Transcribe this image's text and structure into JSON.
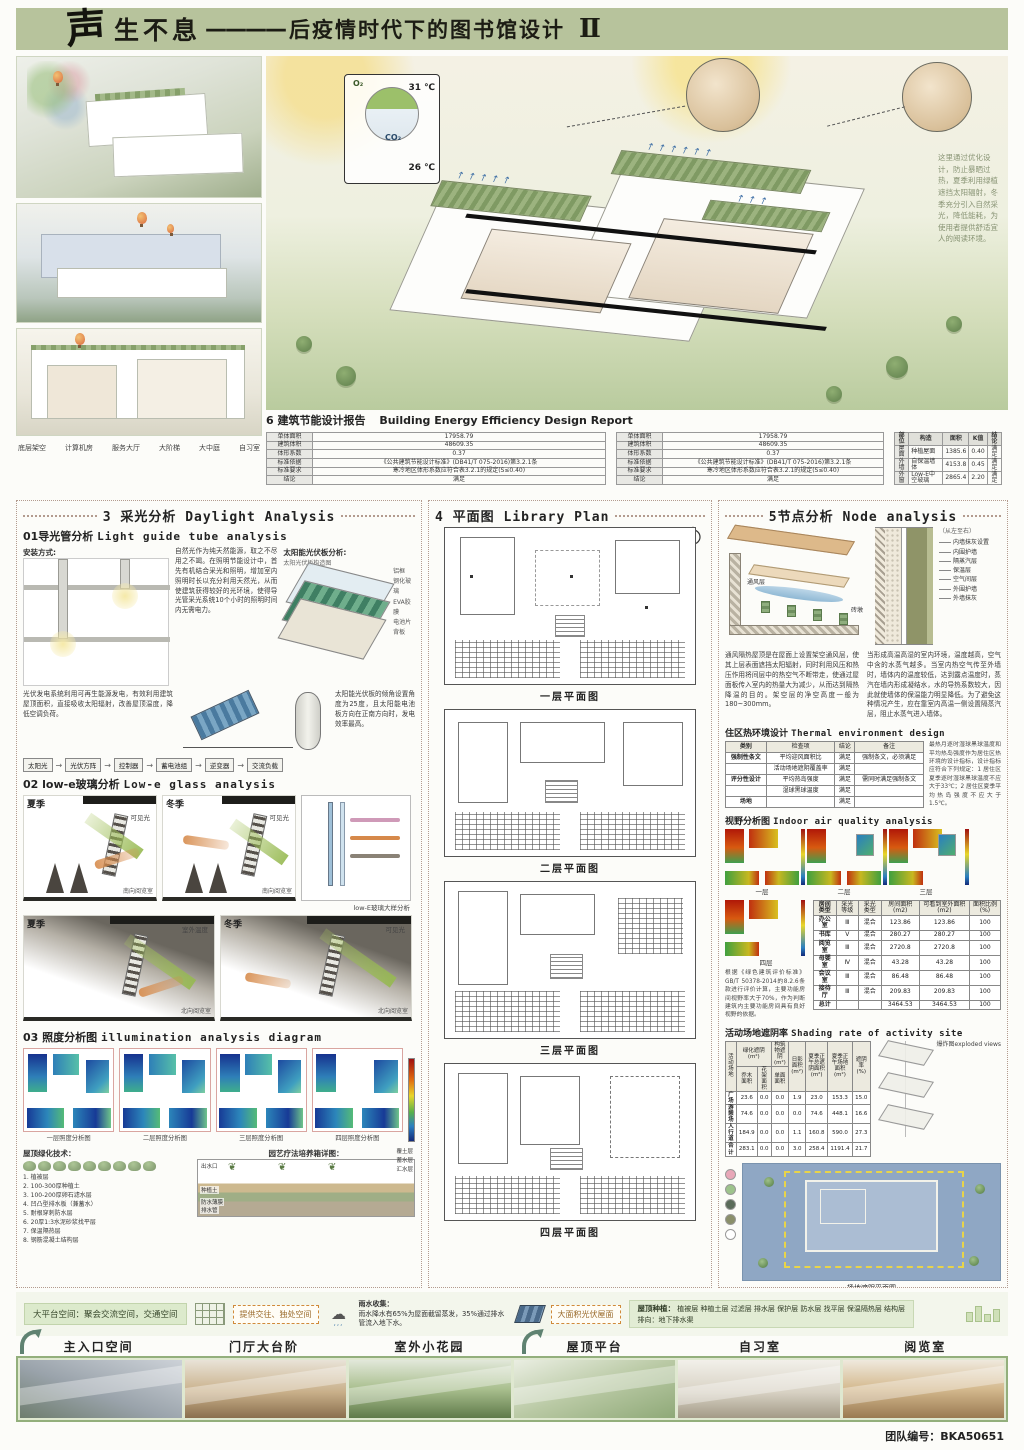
{
  "header": {
    "calligraphy": "声",
    "title": "生不息",
    "dash": "————",
    "subtitle": "后疫情时代下的图书馆设计",
    "numeral": "Ⅱ"
  },
  "top": {
    "section_labels": [
      "底层架空",
      "计算机房",
      "服务大厅",
      "大阶梯",
      "大中庭",
      "自习室"
    ],
    "env": {
      "o2": "O₂",
      "temp_high": "31 ℃",
      "co2": "CO₂",
      "temp_low": "26 ℃"
    },
    "overlay_text": "这里通过优化设计，防止暴晒过热，夏季利用绿植遮挡太阳辐射，冬季充分引入自然采光，降低能耗，为使用者提供舒适宜人的阅读环境。",
    "energy": {
      "heading_zh": "6 建筑节能设计报告",
      "heading_en": "Building Energy Efficiency Design Report",
      "t1_rows": [
        [
          "单体面积",
          "17958.79"
        ],
        [
          "建筑体积",
          "48609.35"
        ],
        [
          "体形系数",
          "0.37"
        ],
        [
          "标准依据",
          "《公共建筑节能设计标准》(DB41/T 075-2016)第3.2.1条"
        ],
        [
          "标准要求",
          "寒冷地区体形系数应符合表3.2.1的规定(S≤0.40)"
        ],
        [
          "结论",
          "满足"
        ]
      ],
      "t2_rows": [
        [
          "单体面积",
          "17958.79"
        ],
        [
          "建筑体积",
          "48609.35"
        ],
        [
          "体形系数",
          "0.37"
        ],
        [
          "标准依据",
          "《公共建筑节能设计标准》(DB41/T 075-2016)第3.2.1条"
        ],
        [
          "标准要求",
          "寒冷地区体形系数应符合表3.2.1的规定(S≤0.40)"
        ],
        [
          "结论",
          "满足"
        ]
      ],
      "t3_head": [
        "部位",
        "构造",
        "面积",
        "K值",
        "结论"
      ],
      "t3_rows": [
        [
          "屋面",
          "种植屋面",
          "1385.6",
          "0.40",
          "满足"
        ],
        [
          "外墙",
          "自保温墙体",
          "4153.8",
          "0.45",
          "满足"
        ],
        [
          "外窗",
          "Low-E中空玻璃",
          "2865.4",
          "2.20",
          "满足"
        ]
      ]
    }
  },
  "daylight": {
    "header": {
      "num": "3",
      "zh": "采光分析",
      "en": "Daylight Analysis"
    },
    "s1_zh": "01导光管分析",
    "s1_en": "Light guide tube analysis",
    "install_label": "安装方式:",
    "para": "自然光作为纯天然能源，取之不尽用之不竭。在照明节能设计中，首先有机结合采光和照明，增加室内照明时长以充分利用天然光，从而使建筑获得较好的光环境，使得导光管采光系统10个小时的照明时间内无需电力。",
    "pv_title": "太阳能光伏板分析:",
    "pv_sub": "太阳光伏板构造图",
    "pv_layers": "铝框\n钢化玻璃\nEVA胶膜\n电池片\n背板",
    "pv_para": "光伏发电系统利用可再生能源发电，有效利用建筑屋顶面积，直接吸收太阳辐射，改善屋顶温度，降低空调负荷。",
    "tilt_note": "太阳能光伏板的倾角设置角度为25度，且太阳能电池板方向在正南方向时，发电效率最高。",
    "flow": [
      "太阳光",
      "光伏方阵",
      "控制器",
      "蓄电池组",
      "逆变器",
      "交流负载"
    ],
    "s2_zh": "02 low-e玻璃分析",
    "s2_en": "Low-e glass analysis",
    "diagrams": [
      {
        "season": "夏季",
        "room": "南向阅览室",
        "beam": "可见光"
      },
      {
        "season": "冬季",
        "room": "南向阅览室",
        "beam": "可见光"
      },
      {
        "season": "夏季",
        "room": "北向阅览室",
        "beam": "室外温度"
      },
      {
        "season": "冬季",
        "room": "北向阅览室",
        "beam": "可见光"
      }
    ],
    "lowe_detail_caption": "low-E玻璃大样分析",
    "s3_zh": "03 照度分析图",
    "s3_en": "illumination analysis diagram",
    "illum_captions": [
      "一层照度分析图",
      "二层照度分析图",
      "三层照度分析图",
      "四层照度分析图"
    ],
    "roof_tech_title": "屋顶绿化技术：",
    "roof_tech_list": "1. 植被层\n2. 100-300厚种植土\n3. 100-200厚卵石滤水层\n4. 凹凸型排水板（兼蓄水）\n5. 耐根穿刺防水层\n6. 20厚1:3水泥砂浆找平层\n7. 保温隔热层\n8. 钢筋混凝土结构层",
    "garden_title": "园艺疗法培养箱详图：",
    "garden_labels": {
      "outlet": "出水口",
      "membrane": "防水薄膜",
      "soil": "种植土",
      "drain": "排水管"
    },
    "garden_side": "覆土层\n蓄水层\n汇水层"
  },
  "plans": {
    "header": {
      "num": "4",
      "zh": "平面图",
      "en": "Library Plan"
    },
    "captions": [
      "一层平面图",
      "二层平面图",
      "三层平面图",
      "四层平面图"
    ]
  },
  "node": {
    "header": {
      "zh": "5节点分析",
      "en": "Node analysis"
    },
    "roof_label_vent": "通风层",
    "roof_label_brick": "砖墩",
    "wall_dir": "（从左至右）",
    "wall_layers": [
      "内墙抹灰设置",
      "内围护墙",
      "隔蒸汽层",
      "保温层",
      "空气间层",
      "外围护墙",
      "外墙抹灰"
    ],
    "para1": "通风隔热屋顶是在屋面上设置架空通风层，使其上层表面遮挡太阳辐射，同时利用风压和热压作用将间层中的热空气不断带走，使通过屋面板传入室内的热量大为减少，从而达到隔热降温的目的。架空层的净空高度一般为180~300mm。",
    "para2": "当形成高温高湿的室内环境，温度越高，空气中含的水蒸气越多。当室内热空气传至外墙时，墙体内的温度较低，达到露点温度时，蒸汽在墙内形成凝结水，水的导热系数较大，因此就使墙体的保温能力明显降低。为了避免这种情况产生，应在靠室内高温一侧设置隔蒸汽层，阻止水蒸气进入墙体。",
    "thermal_zh": "住区热环境设计",
    "thermal_en": "Thermal environment design",
    "thermal_head": [
      "类别",
      "检查项",
      "结论",
      "备注"
    ],
    "thermal_rows": [
      [
        "强制性条文",
        "平均迎风面积比",
        "满足",
        "强制条文，必须满足"
      ],
      [
        "",
        "活动场地遮阴覆盖率",
        "满足",
        ""
      ],
      [
        "评分性设计",
        "平均热岛强度",
        "满足",
        "需同时满足强制条文"
      ],
      [
        "",
        "湿球黑球温度",
        "满足",
        ""
      ],
      [
        "场地",
        "",
        "满足",
        ""
      ]
    ],
    "thermal_note": "最热月逐时湿球黑球温度和平均热岛强度作为居住区热环境的设计指标，设计指标应符合下列规定：1 居住区夏季逐时湿球黑球温度不应大于33℃；2 居住区夏季平均热岛强度不应大于1.5℃。",
    "view_zh": "视野分析图",
    "view_en": "Indoor air quality analysis",
    "view_floors": [
      "一层",
      "二层",
      "三层",
      "四层"
    ],
    "view_note": "根据《绿色建筑评价标准》GB/T 50378-2014的8.2.6条款进行评价计算，主要功能房间视野率大于70%，作为判断建筑内主要功能房间具有良好视野的依据。",
    "room_head": [
      "房间类型",
      "采光等级",
      "采光类型",
      "房间面积(m2)",
      "可看到室外面积(m2)",
      "面积比例(%)"
    ],
    "room_rows": [
      [
        "办公室",
        "Ⅲ",
        "混合",
        "123.86",
        "123.86",
        "100"
      ],
      [
        "书库",
        "Ⅴ",
        "混合",
        "280.27",
        "280.27",
        "100"
      ],
      [
        "阅览室",
        "Ⅲ",
        "混合",
        "2720.8",
        "2720.8",
        "100"
      ],
      [
        "母婴室",
        "Ⅳ",
        "混合",
        "43.28",
        "43.28",
        "100"
      ],
      [
        "会议室",
        "Ⅲ",
        "混合",
        "86.48",
        "86.48",
        "100"
      ],
      [
        "接待厅",
        "Ⅲ",
        "混合",
        "209.83",
        "209.83",
        "100"
      ],
      [
        "总计",
        "",
        "",
        "3464.53",
        "3464.53",
        "100"
      ]
    ],
    "shading_zh": "活动场地遮阴率",
    "shading_en": "Shading rate of activity site",
    "shading_h": [
      "活动场地",
      "绿化遮阴(m²)",
      "构筑物遮阴(m²)",
      "日影面积(m²)",
      "夏季正午总遮阴面积(m²)",
      "夏季正午场地面积(m²)",
      "遮阴率(%)"
    ],
    "shading_sub": [
      "乔木面积",
      "花架面积",
      "单面面积"
    ],
    "shading_rows": [
      [
        "广场",
        "23.6",
        "0.0",
        "0.0",
        "1.9",
        "23.0",
        "153.3",
        "15.0"
      ],
      [
        "游憩场",
        "74.6",
        "0.0",
        "0.0",
        "0.0",
        "74.6",
        "448.1",
        "16.6"
      ],
      [
        "人行道",
        "184.9",
        "0.0",
        "0.0",
        "1.1",
        "160.8",
        "590.0",
        "27.3"
      ],
      [
        "合计",
        "283.1",
        "0.0",
        "0.0",
        "3.0",
        "258.4",
        "1191.4",
        "21.7"
      ]
    ],
    "exploded_label": "爆炸图exploded views",
    "siteplan_caption": "场地遮阴平面图",
    "roof_index_zh": "屋顶热环境指标",
    "roof_index_en": "Roof thermal environment index",
    "roof_head": [
      "建筑",
      "屋顶面积(m2)",
      "屋顶绿化面积(m2)",
      "太阳能板遮阴面积(m2)",
      "太阳辐射反射系数不小于0.4屋面面积(m2)",
      "屋顶绿化、太阳能板遮阴及反射达标面积占屋面比例(%)"
    ],
    "roof_rows": [
      [
        "",
        "1385.6",
        "482.1",
        "140.3",
        "740.2",
        "100.0"
      ],
      [
        "合计",
        "1385.6",
        "482.1",
        "140.3",
        "740.2",
        "100.0"
      ]
    ]
  },
  "bottom": {
    "platform": "大平台空间：聚会交流空间，交通空间",
    "social": "提供交往、独处空间",
    "rain_title": "雨水收集：",
    "rain_text": "雨水降水有65%为屋面截留蒸发，35%通过排水管流入地下水。",
    "pv_box": "大面积光伏屋面",
    "roof_plant_label": "屋顶种植：",
    "roof_plant_layers": "植被层  种植土层  过滤层  排水层  保护层  防水层  找平层  保温隔热层  结构层",
    "drain_text": "排向：地下排水渠",
    "photo_labels": [
      "主入口空间",
      "门厅大台阶",
      "室外小花园",
      "屋顶平台",
      "自习室",
      "阅览室"
    ]
  },
  "footer": {
    "team": "团队编号：BKA50651"
  }
}
